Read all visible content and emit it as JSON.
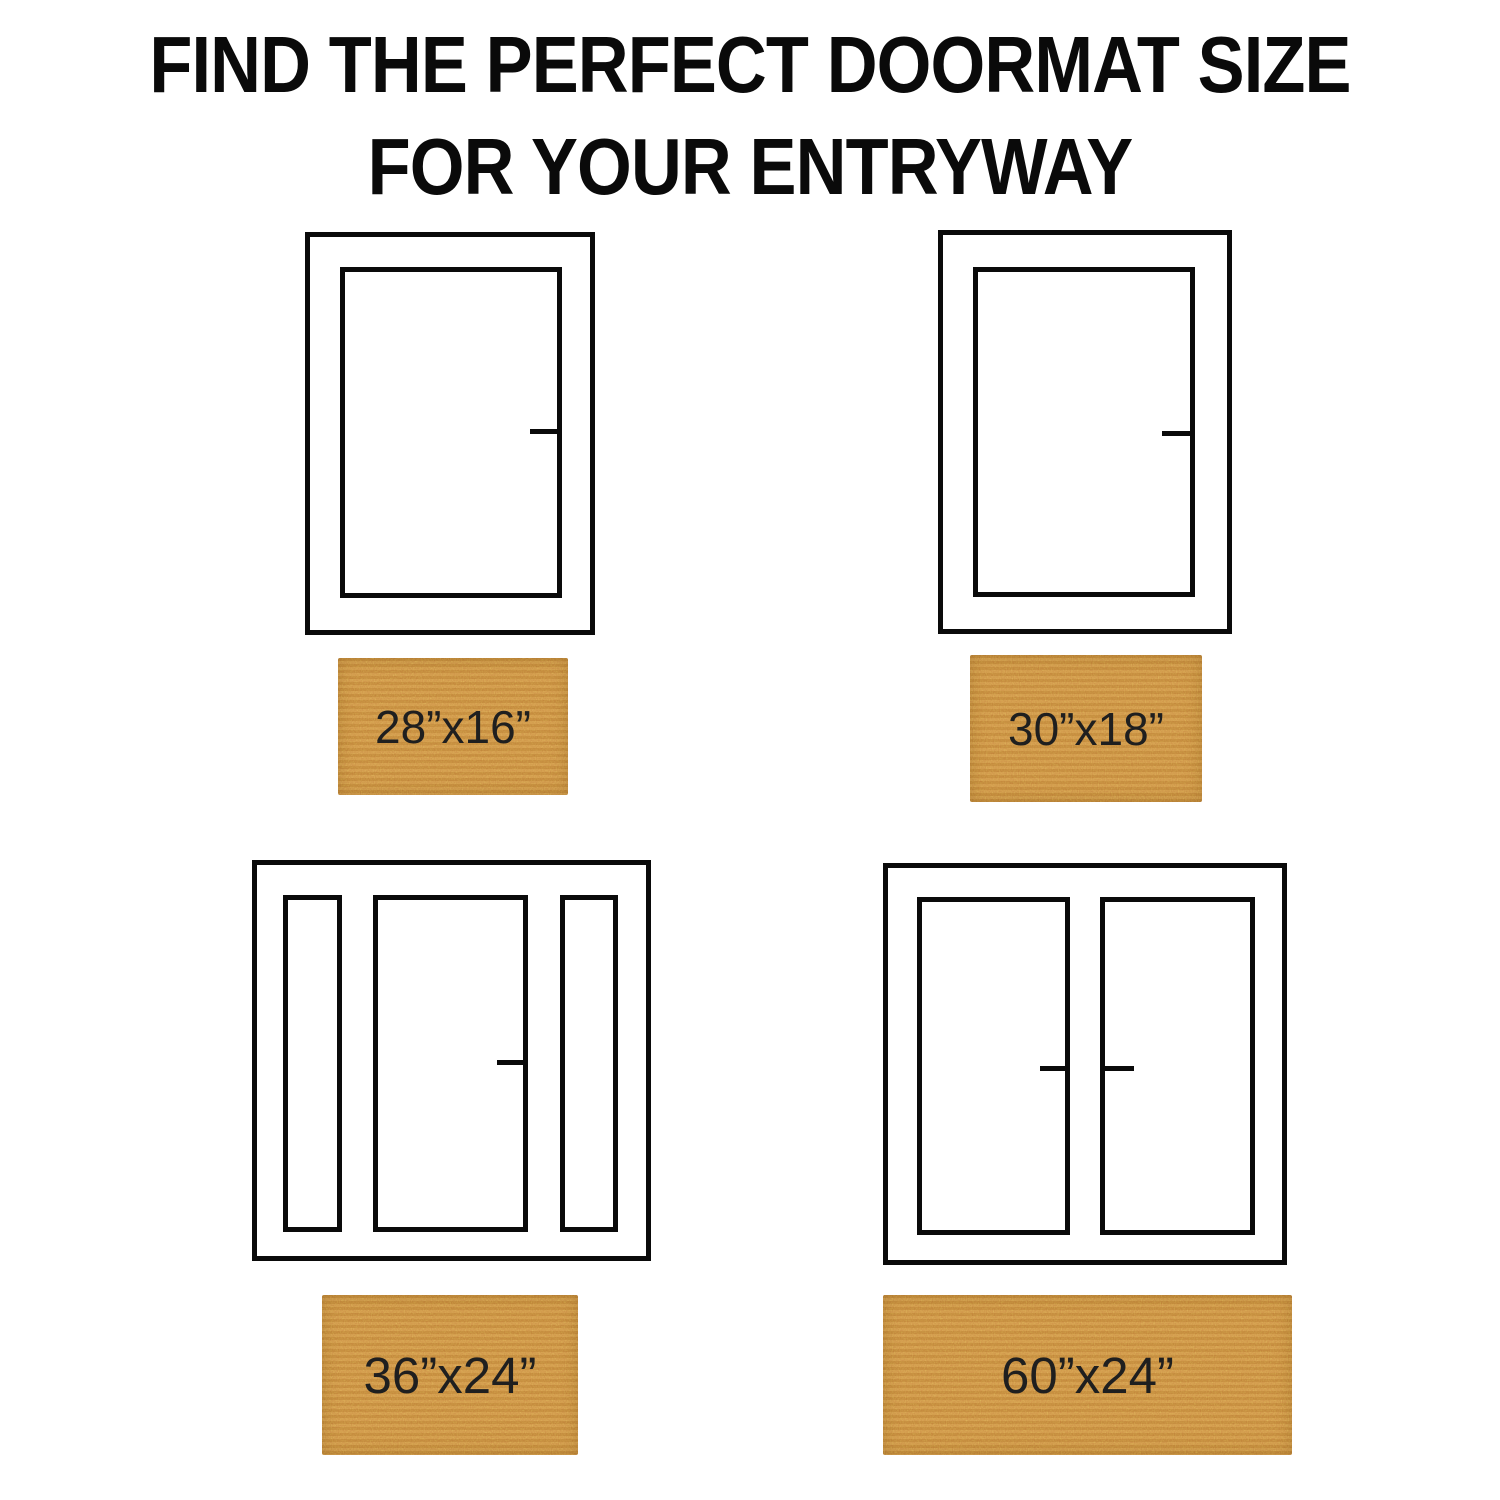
{
  "title": {
    "line1": "FIND THE PERFECT DOORMAT SIZE",
    "line2": "FOR YOUR ENTRYWAY"
  },
  "colors": {
    "background": "#ffffff",
    "line": "#0a0a0a",
    "mat_base": "#c9893e",
    "label_text": "#1f1f1f"
  },
  "entries": [
    {
      "door_type": "single-door",
      "mat_size": "28”x16”"
    },
    {
      "door_type": "single-door",
      "mat_size": "30”x18”"
    },
    {
      "door_type": "door-with-two-sidelights",
      "mat_size": "36”x24”"
    },
    {
      "door_type": "double-door",
      "mat_size": "60”x24”"
    }
  ]
}
